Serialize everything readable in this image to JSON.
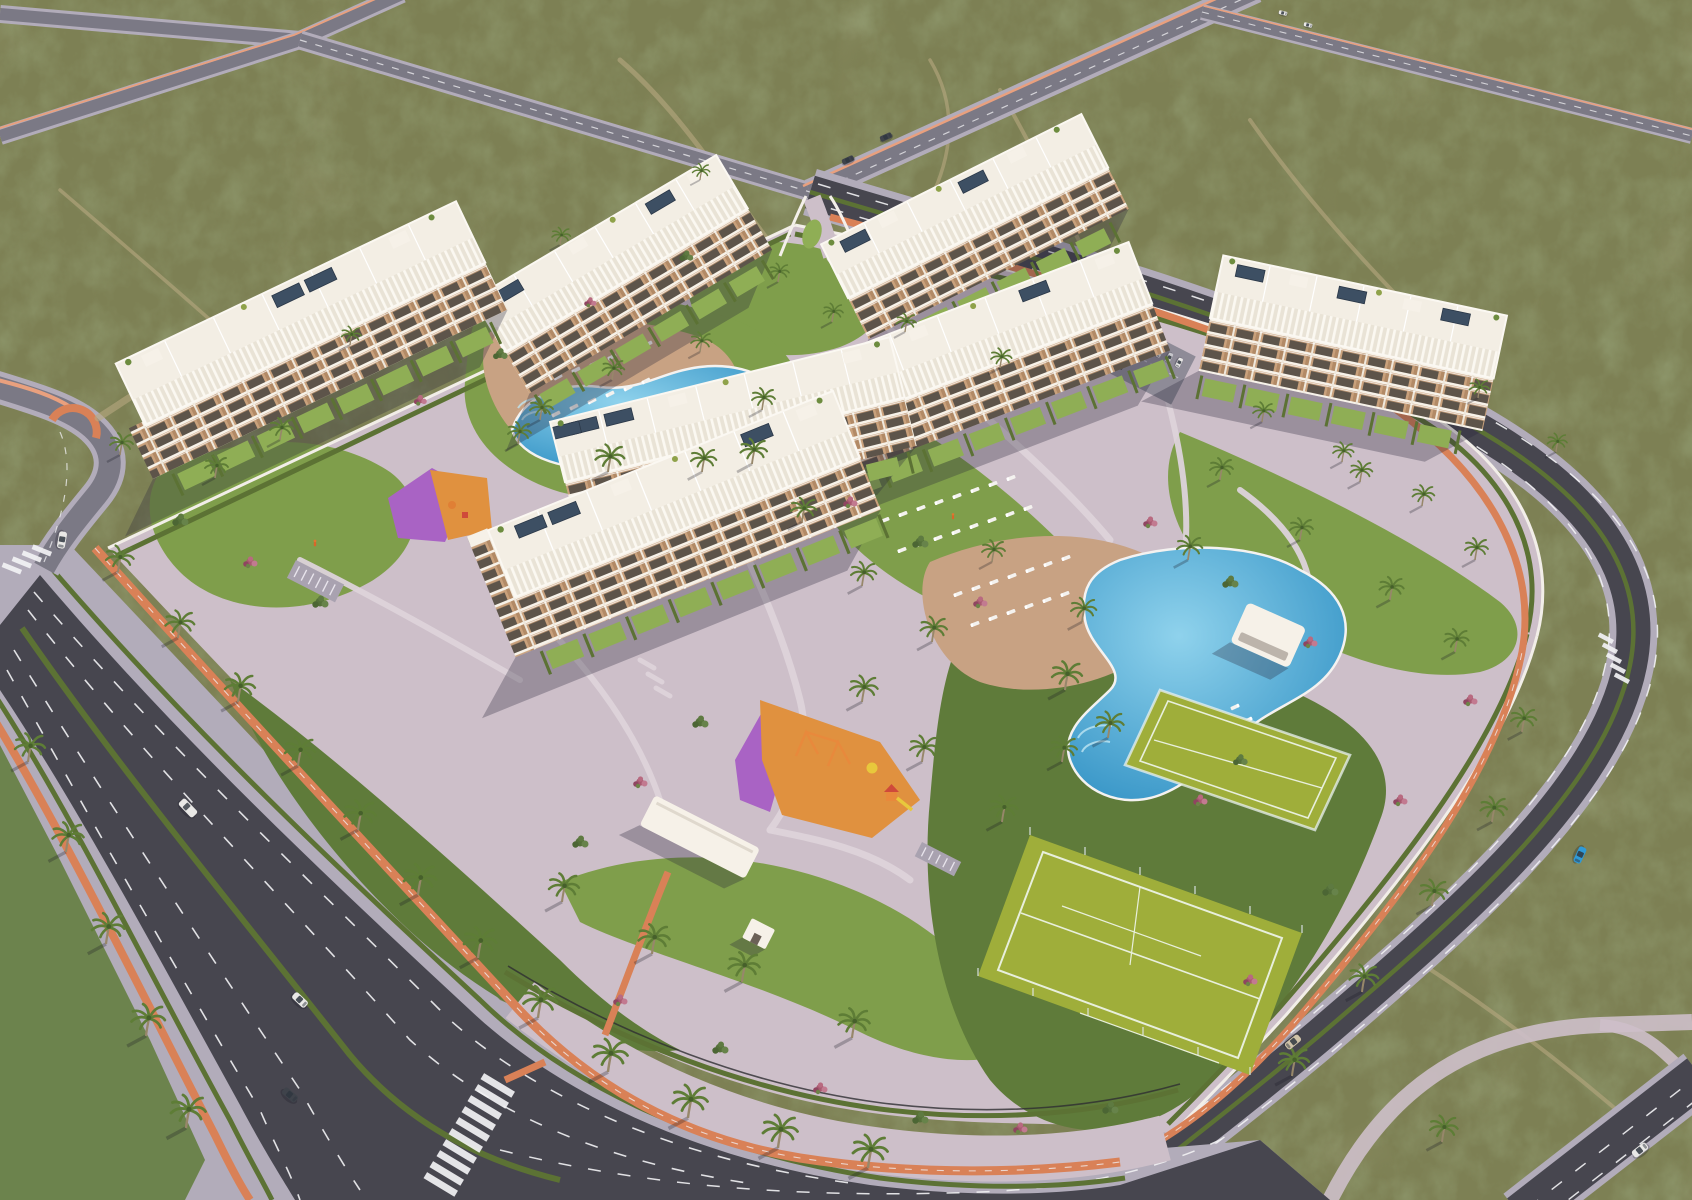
{
  "scene": {
    "title": "Aerial render of a Mediterranean apartment resort development",
    "description": "Golden-hour aerial 3D architectural rendering of a gated residential complex of white apartment blocks set in semi-arid scrubland, ringed by new boulevards with orange cycle lanes, hedge medians, palm trees, lagoon pools, sports courts and playgrounds",
    "style": "photorealistic CGI, high oblique drone view",
    "lighting": "low warm sun from the upper right casting long shadows toward the lower left"
  },
  "palette": {
    "scrub_base": "#7d8054",
    "scrub_dark": "#4f5c36",
    "trail_sand": "#b7a981",
    "road_asphalt_dark": "#47464f",
    "road_asphalt_light": "#7b7985",
    "sidewalk": "#b2acba",
    "paving": "#cdbfc9",
    "paving_light": "#ddd3da",
    "bike_path_orange": "#d98157",
    "salmon_median": "#e9a07e",
    "lane_marking": "#f2f2f4",
    "lawn": "#7f9e4b",
    "lawn_bright": "#8fae55",
    "lawn_dark": "#5f7b3a",
    "hedge": "#5c7234",
    "palm_frond": "#5e7d36",
    "shrub_magenta": "#a85a70",
    "shrub_pink": "#c27a90",
    "building_white": "#f6f1e8",
    "roof_white": "#f3eee4",
    "balcony_tan": "#c9a17c",
    "window_dark": "#5d544a",
    "solar_panel": "#3d4f63",
    "pool_deep": "#2e8fc3",
    "pool_light": "#8fd2ec",
    "deck_tan": "#c8a283",
    "lounger": "#f4f2ef",
    "court_green": "#9fae3a",
    "court_line": "#e8efdc",
    "playground_orange": "#e0913f",
    "playground_purple": "#a963c4",
    "car_white": "#e9e8e6",
    "car_silver": "#c6c6cb",
    "car_dark": "#3f434b",
    "car_blue": "#2f9ad8",
    "car_beige": "#cfc2a8",
    "shadow": "rgba(40,36,56,0.30)"
  },
  "environment": {
    "terrain": "mottled olive scrubland with sandy walking trails",
    "trails_visible": 6,
    "scrub_coverage": "entire perimeter outside the road grid"
  },
  "roads": {
    "boulevard": {
      "description": "wide dual-carriageway boulevard along the south-west side",
      "lanes_per_direction": 3,
      "features": [
        "green hedge median",
        "orange cycle lanes both sides",
        "palm-lined sidewalks",
        "dashed white lane markings",
        "zebra crossings"
      ]
    },
    "perimeter_road": {
      "description": "curving dual carriageway wrapping the north-east and east sides",
      "features": [
        "hedge median",
        "orange cycle path on complex side",
        "crosswalk near east corner"
      ]
    },
    "highway": {
      "description": "straight road with salmon median stripe running to the top edge through two X-junctions",
      "junctions": 2
    },
    "top_right_road": {
      "description": "distant road across the top-right corner with two small cars"
    },
    "crosswalks": 3,
    "vehicles": [
      {
        "type": "van",
        "color": "white",
        "location": "boulevard north-east carriageway"
      },
      {
        "type": "car",
        "color": "white",
        "location": "boulevard north-east carriageway"
      },
      {
        "type": "car",
        "color": "dark",
        "location": "boulevard south-west carriageway"
      },
      {
        "type": "car",
        "color": "white",
        "location": "west connector road"
      },
      {
        "type": "car",
        "color": "blue",
        "location": "east perimeter curve"
      },
      {
        "type": "car",
        "color": "beige",
        "location": "south-east perimeter road"
      },
      {
        "type": "car",
        "color": "white",
        "location": "bottom-right corner road, partially cropped"
      },
      {
        "type": "car",
        "color": "dark",
        "location": "highway near north junction"
      },
      {
        "type": "car",
        "color": "dark",
        "location": "highway near north junction"
      },
      {
        "type": "car",
        "color": "white",
        "location": "top-right distant junction"
      },
      {
        "type": "car",
        "color": "white",
        "location": "top-right distant junction"
      }
    ],
    "parked_cars_in_lot": 7
  },
  "complex": {
    "boundary": "white perimeter wall with hedges, black railing fence along the south plaza",
    "buildings": [
      {
        "id": "block-1",
        "position": "far west",
        "floors": 4,
        "features": [
          "roof pergolas",
          "solar panels",
          "curved white balconies",
          "hedged private gardens"
        ]
      },
      {
        "id": "block-2",
        "position": "north-west",
        "floors": 4,
        "features": [
          "roof pergolas",
          "solar panels",
          "private gardens"
        ]
      },
      {
        "id": "block-3",
        "position": "north-centre",
        "floors": 4,
        "features": [
          "roof pergolas",
          "solar panels",
          "private gardens"
        ]
      },
      {
        "id": "block-4",
        "position": "north-east",
        "floors": 4,
        "features": [
          "roof pergolas",
          "solar panels",
          "private gardens",
          "residents parking alongside"
        ]
      },
      {
        "id": "block-5",
        "position": "centre-east",
        "floors": 4,
        "features": [
          "roof pergolas",
          "solar panels",
          "corner tower balconies"
        ]
      },
      {
        "id": "block-6",
        "position": "centre-west",
        "floors": 4,
        "features": [
          "roof pergolas",
          "solar panels"
        ]
      },
      {
        "id": "block-7",
        "position": "south-west",
        "floors": 4,
        "features": [
          "roof pergolas",
          "solar panels",
          "tall corner tower"
        ]
      }
    ],
    "pools": [
      {
        "id": "north-lagoon-pool",
        "shape": "lagoon",
        "sun_loungers": 20,
        "deck": "tan terrace with palms"
      },
      {
        "id": "main-lagoon-pool",
        "shape": "lagoon",
        "sun_loungers": 32,
        "deck": "tan terrace",
        "pavilion": "white flat-roof pool house"
      }
    ],
    "sports_courts": [
      {
        "id": "padel-court",
        "surface": "lime green",
        "enclosure": "glass and mesh"
      },
      {
        "id": "tennis-court",
        "surface": "lime green",
        "markings": "white"
      }
    ],
    "playgrounds": [
      {
        "id": "west-playground",
        "surface_colors": [
          "purple",
          "orange"
        ]
      },
      {
        "id": "south-playground",
        "surface_colors": [
          "purple",
          "orange"
        ],
        "equipment": [
          "swing set",
          "slide tower",
          "yellow parasol",
          "climbers"
        ]
      }
    ],
    "entrances": [
      {
        "id": "north-gate",
        "features": [
          "teardrop grass island",
          "curved white walls"
        ]
      },
      {
        "id": "south-gate",
        "features": [
          "long white canopy",
          "gatehouse",
          "orange cycle path branch"
        ]
      }
    ],
    "amenities": [
      "bike racks west",
      "bike racks near south gate",
      "winding white garden paths",
      "garden stairs"
    ],
    "landscape": {
      "palm_trees": 68,
      "flowering_shrubs": "magenta and pink bougainvillea beds",
      "private_gardens": "hedged lawns along every ground floor",
      "people_visible": 2
    }
  }
}
